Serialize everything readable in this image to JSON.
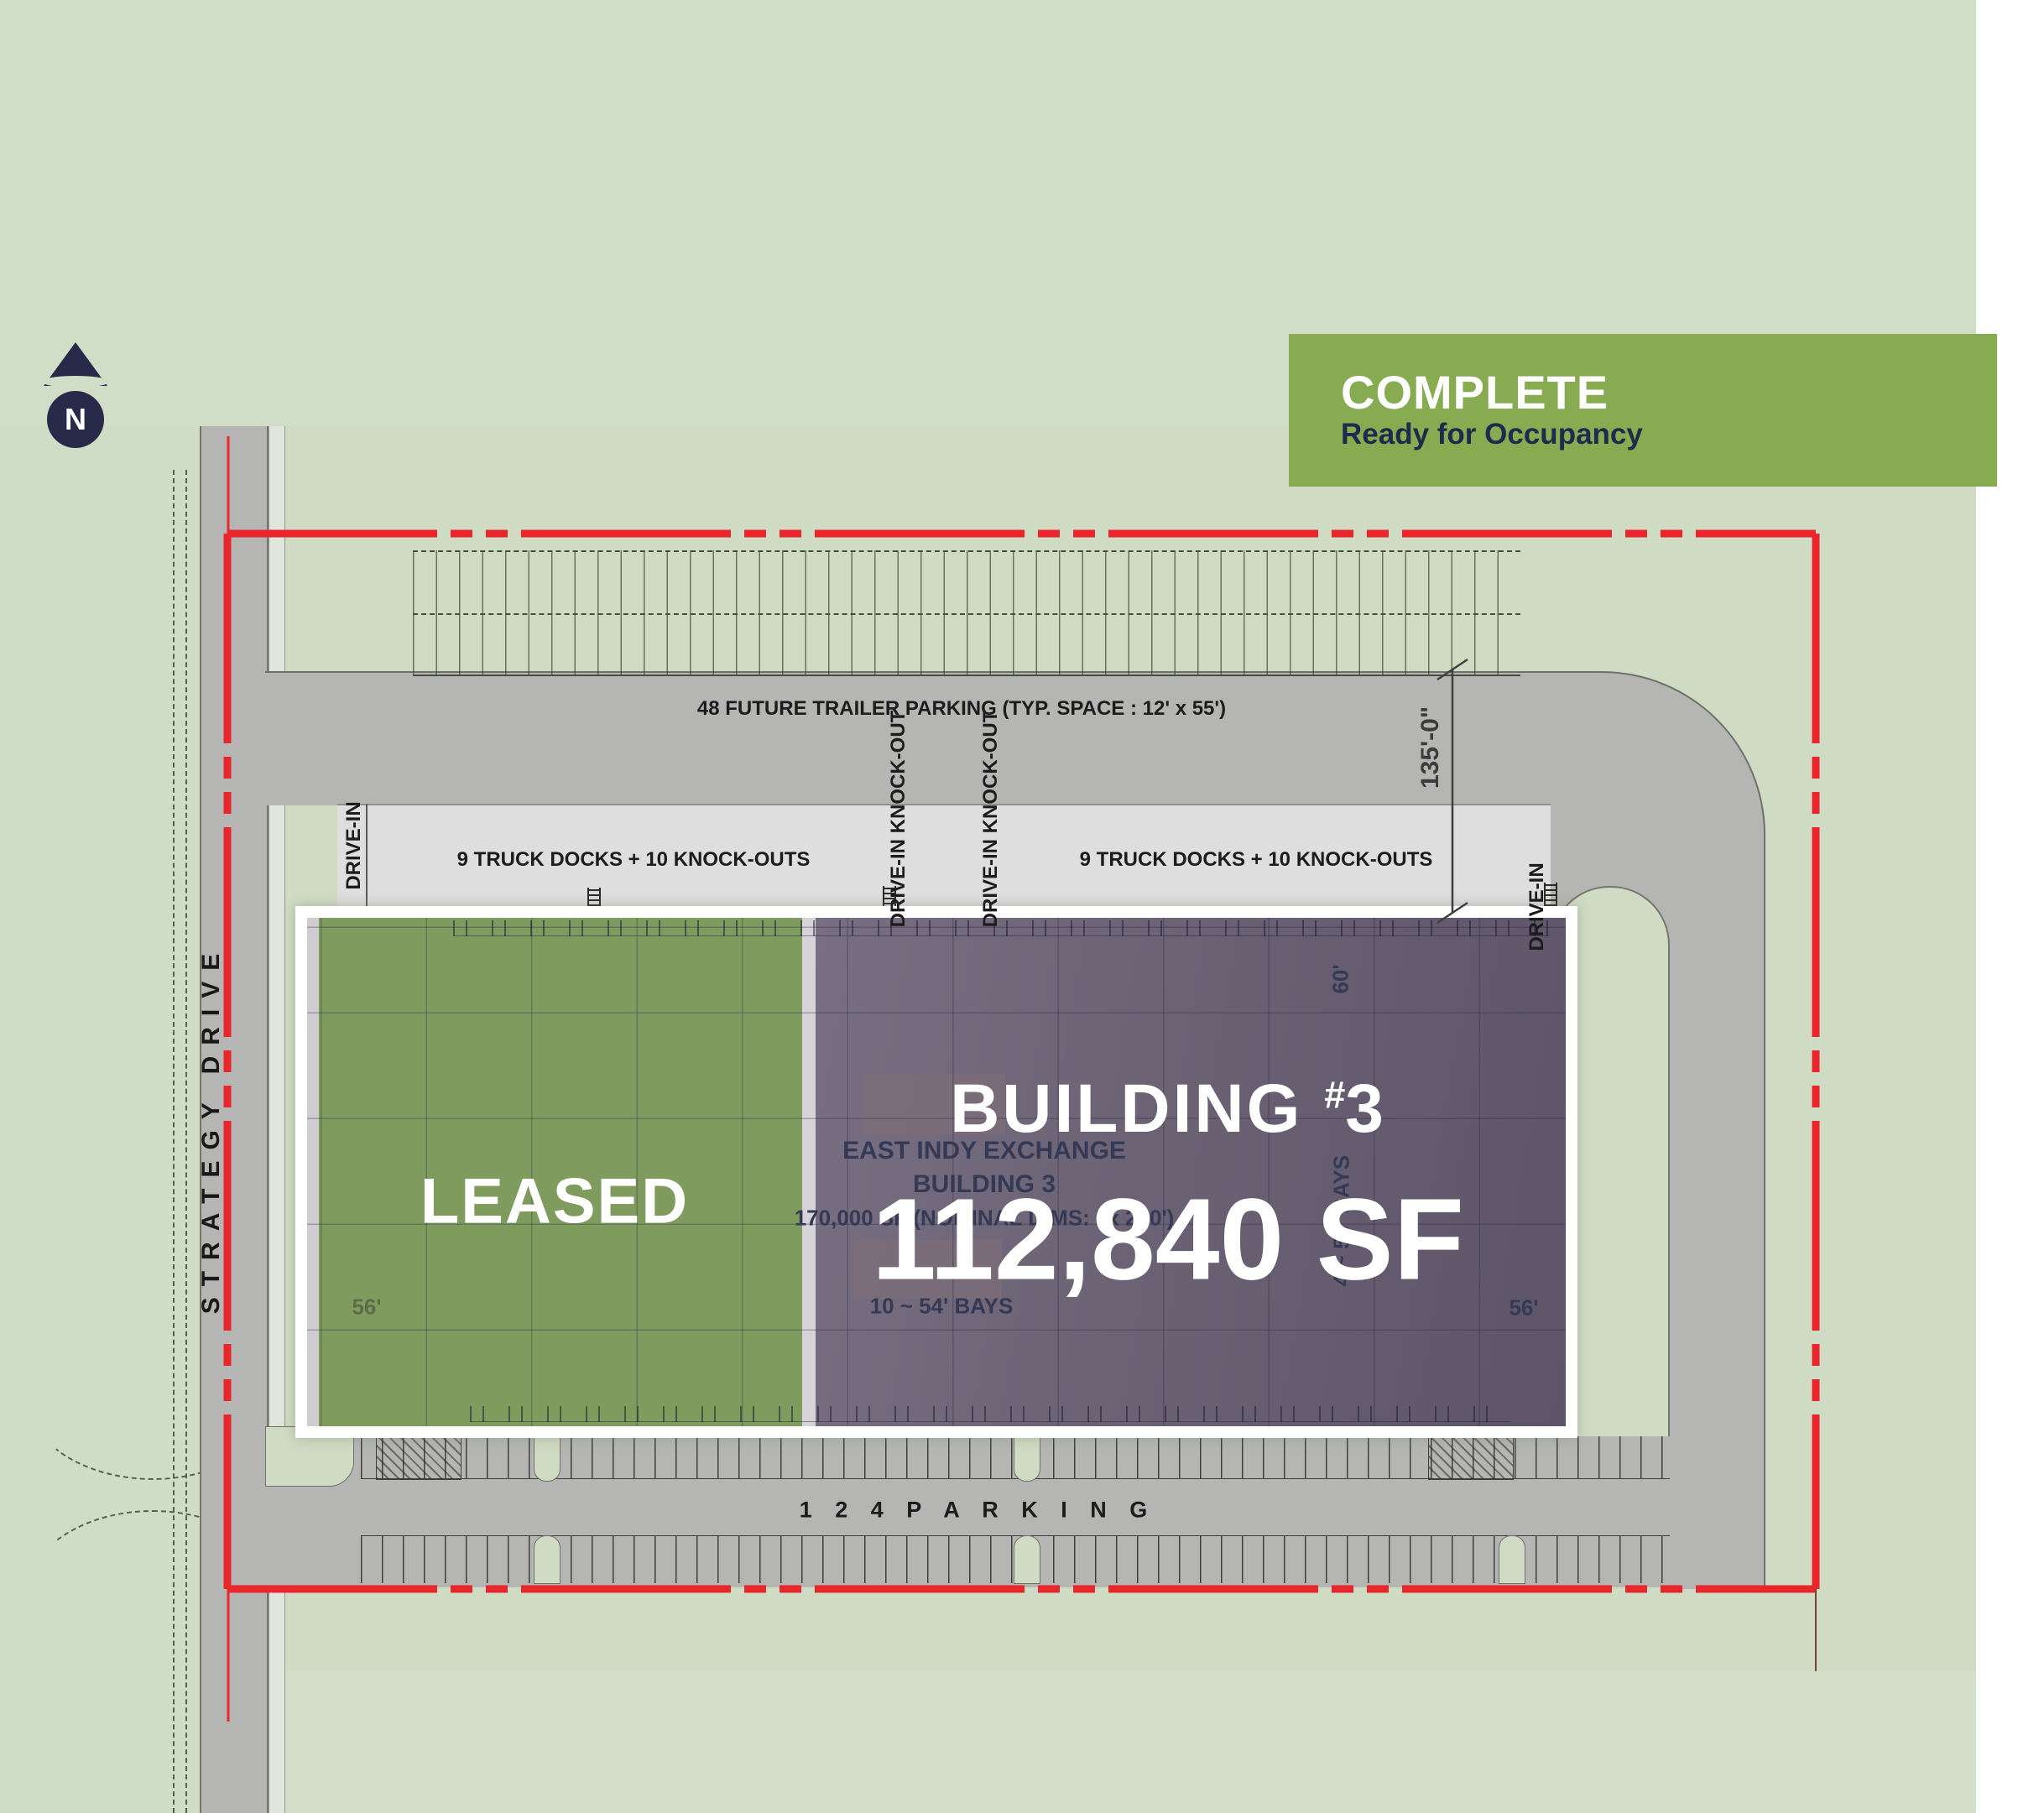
{
  "banner": {
    "title": "COMPLETE",
    "subtitle": "Ready for Occupancy"
  },
  "compass": {
    "n": "N"
  },
  "street": {
    "name": "STRATEGY DRIVE"
  },
  "labels": {
    "trailer_parking": "48 FUTURE TRAILER PARKING   (TYP. SPACE :  12' x 55')",
    "truck_docks_left": "9 TRUCK DOCKS + 10 KNOCK-OUTS",
    "truck_docks_right": "9 TRUCK DOCKS + 10 KNOCK-OUTS",
    "drive_in_left": "DRIVE-IN",
    "drive_in_right": "DRIVE-IN",
    "drive_in_knockout_a": "DRIVE-IN KNOCK-OUT",
    "drive_in_knockout_b": "DRIVE-IN KNOCK-OUT",
    "dim_135": "135'-0\"",
    "parking_count": "1 2 4   P A R K I N G"
  },
  "building": {
    "leased": "LEASED",
    "overlay": {
      "word": "BUILDING",
      "hash": "#",
      "number": "3",
      "sf": "112,840 SF"
    },
    "plan": {
      "line1": "EAST INDY EXCHANGE",
      "line2": "BUILDING 3",
      "line3": "170,000 SF  (NOMINAL DIMS:       ' x 260')",
      "bays_bottom": "10 ~ 54' BAYS",
      "bays_right": "4 ~ 50' BAYS",
      "dim_60": "60'",
      "dim_56_left": "56'",
      "dim_56_right": "56'"
    }
  },
  "colors": {
    "boundary_red": "#e8262b",
    "banner_green": "#86ab51",
    "leased_green": "#7f9c5e",
    "building_purple": "#6b6274",
    "navy": "#272b49",
    "road_gray": "#b5b6b4",
    "background_green": "#cfdcc3"
  }
}
